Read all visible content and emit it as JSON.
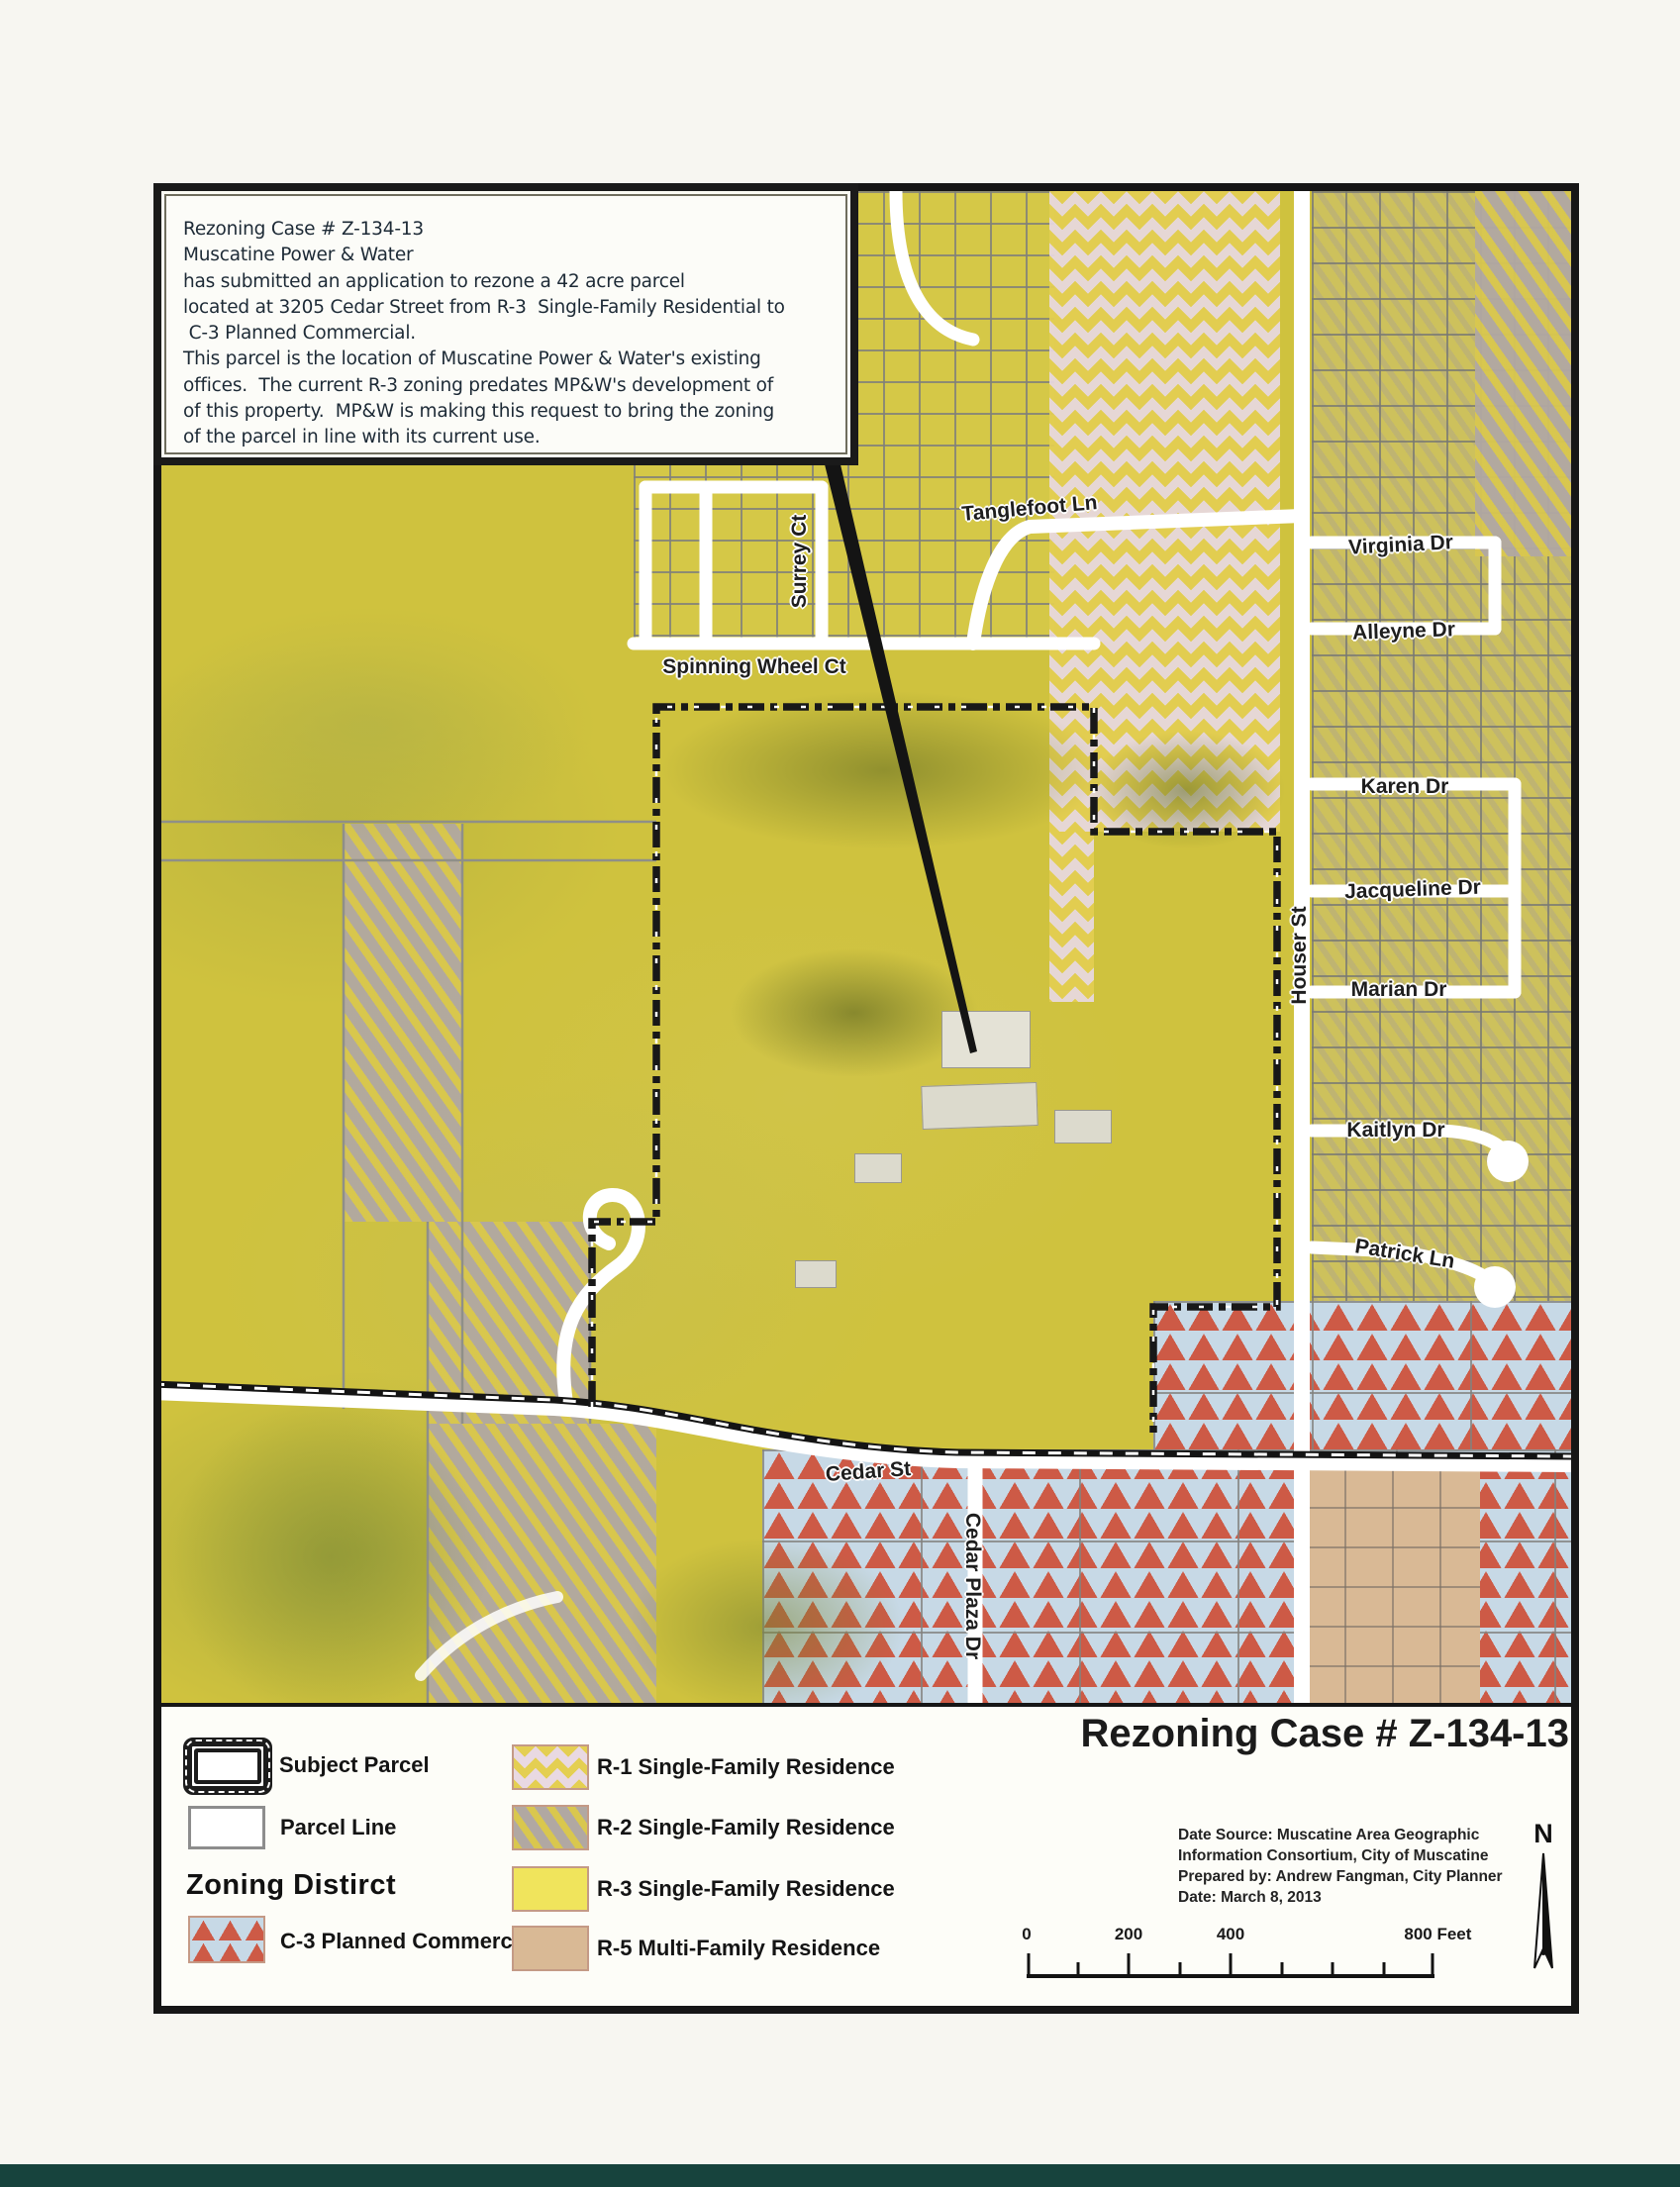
{
  "info_box": {
    "lines": [
      "Rezoning Case # Z-134-13",
      "Muscatine Power & Water",
      "has submitted an application to rezone a 42 acre parcel",
      "located at 3205 Cedar Street from R-3  Single-Family Residential to",
      " C-3 Planned Commercial.",
      "This parcel is the location of Muscatine Power & Water's existing",
      "offices.  The current R-3 zoning predates MP&W's development of",
      "of this property.  MP&W is making this request to bring the zoning",
      "of the parcel in line with its current use."
    ]
  },
  "map": {
    "street_labels": [
      {
        "name": "Tanglefoot Ln"
      },
      {
        "name": "Surrey Ct"
      },
      {
        "name": "Spinning Wheel Ct"
      },
      {
        "name": "Virginia Dr"
      },
      {
        "name": "Alleyne Dr"
      },
      {
        "name": "Karen Dr"
      },
      {
        "name": "Jacqueline Dr"
      },
      {
        "name": "Marian Dr"
      },
      {
        "name": "Houser St"
      },
      {
        "name": "Kaitlyn Dr"
      },
      {
        "name": "Patrick Ln"
      },
      {
        "name": "Cedar St"
      },
      {
        "name": "Cedar Plaza Dr"
      }
    ]
  },
  "legend": {
    "subject_parcel_label": "Subject Parcel",
    "parcel_line_label": "Parcel Line",
    "zoning_heading": "Zoning Distirct",
    "items": [
      {
        "code": "C-3",
        "label": "C-3 Planned Commercial"
      },
      {
        "code": "R-1",
        "label": "R-1 Single-Family Residence"
      },
      {
        "code": "R-2",
        "label": "R-2 Single-Family Residence"
      },
      {
        "code": "R-3",
        "label": "R-3 Single-Family Residence"
      },
      {
        "code": "R-5",
        "label": "R-5 Multi-Family Residence"
      }
    ]
  },
  "title_block": {
    "title": "Rezoning Case # Z-134-13",
    "credits": [
      "Date Source: Muscatine Area Geographic",
      "Information Consortium, City of Muscatine",
      "Prepared by: Andrew Fangman, City Planner",
      "Date: March 8, 2013"
    ],
    "north_label": "N"
  },
  "scale_bar": {
    "tick_labels": [
      "0",
      "200",
      "400",
      "800 Feet"
    ]
  },
  "colors": {
    "map_base_yellow": "#cfc23e",
    "r1_diamond_pink": "#e9d9e2",
    "r1_diamond_yellow": "#e4cf52",
    "r2_yellow": "#d9c74e",
    "r2_gray": "#b1a8a2",
    "r3_yellow": "#f0e45c",
    "r5_tan": "#d9b995",
    "c3_blue": "#c7d9e6",
    "c3_red": "#cd5a46"
  }
}
